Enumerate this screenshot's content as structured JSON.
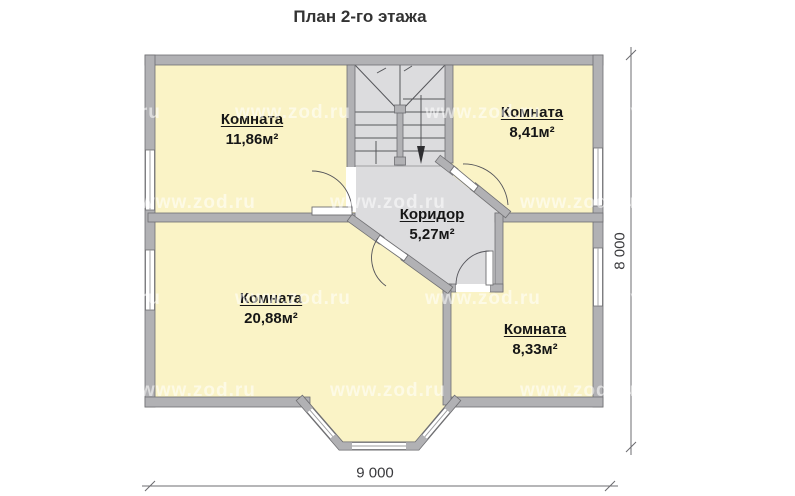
{
  "title": "План 2-го этажа",
  "watermark": "www.zod.ru",
  "rooms": [
    {
      "name": "Комната",
      "area": "11,86м²"
    },
    {
      "name": "Комната",
      "area": "8,41м²"
    },
    {
      "name": "Коридор",
      "area": "5,27м²"
    },
    {
      "name": "Комната",
      "area": "20,88м²"
    },
    {
      "name": "Комната",
      "area": "8,33м²"
    }
  ],
  "dimensions": {
    "width": "9 000",
    "height": "8 000"
  },
  "colors": {
    "room_fill": "#faf3c6",
    "hall_fill": "#dcdcde",
    "wall_fill": "#b1b1b4",
    "wall_edge": "#6f6f72"
  }
}
